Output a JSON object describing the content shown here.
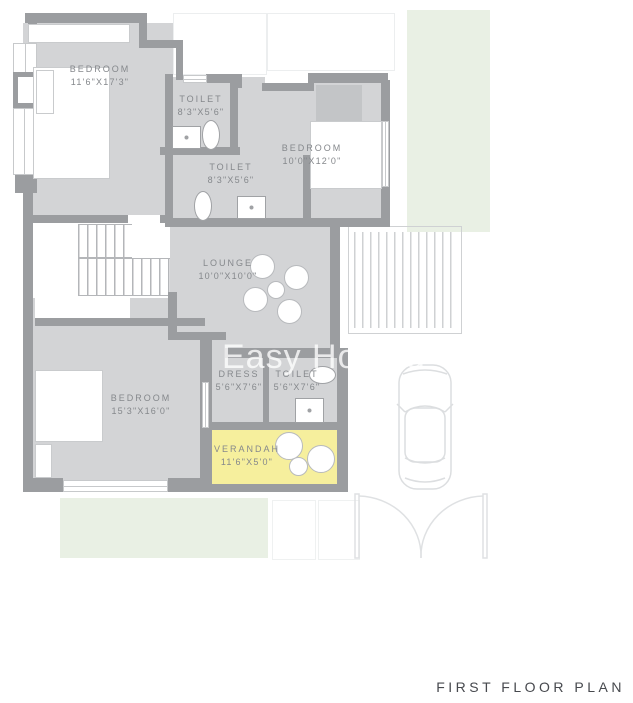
{
  "title": "FIRST FLOOR PLAN",
  "watermark": "Easy Hops d",
  "colors": {
    "room_fill": "#d3d4d6",
    "wall": "#9b9da0",
    "verandah_highlight": "#f6ef9d",
    "garden_green": "#e9f0e4",
    "label_text": "#85888c",
    "title_text": "#47494e",
    "background": "#ffffff"
  },
  "rooms": [
    {
      "name": "BEDROOM",
      "dims": "11'6\"X17'3\""
    },
    {
      "name": "TOILET",
      "dims": "8'3\"X5'6\""
    },
    {
      "name": "TOILET",
      "dims": "8'3\"X5'6\""
    },
    {
      "name": "BEDROOM",
      "dims": "10'0\"X12'0\""
    },
    {
      "name": "LOUNGE",
      "dims": "10'0\"X10'0\""
    },
    {
      "name": "BEDROOM",
      "dims": "15'3\"X16'0\""
    },
    {
      "name": "DRESS",
      "dims": "5'6\"X7'6\""
    },
    {
      "name": "TOILET",
      "dims": "5'6\"X7'6\""
    },
    {
      "name": "VERANDAH",
      "dims": "11'6\"X5'0\""
    }
  ]
}
